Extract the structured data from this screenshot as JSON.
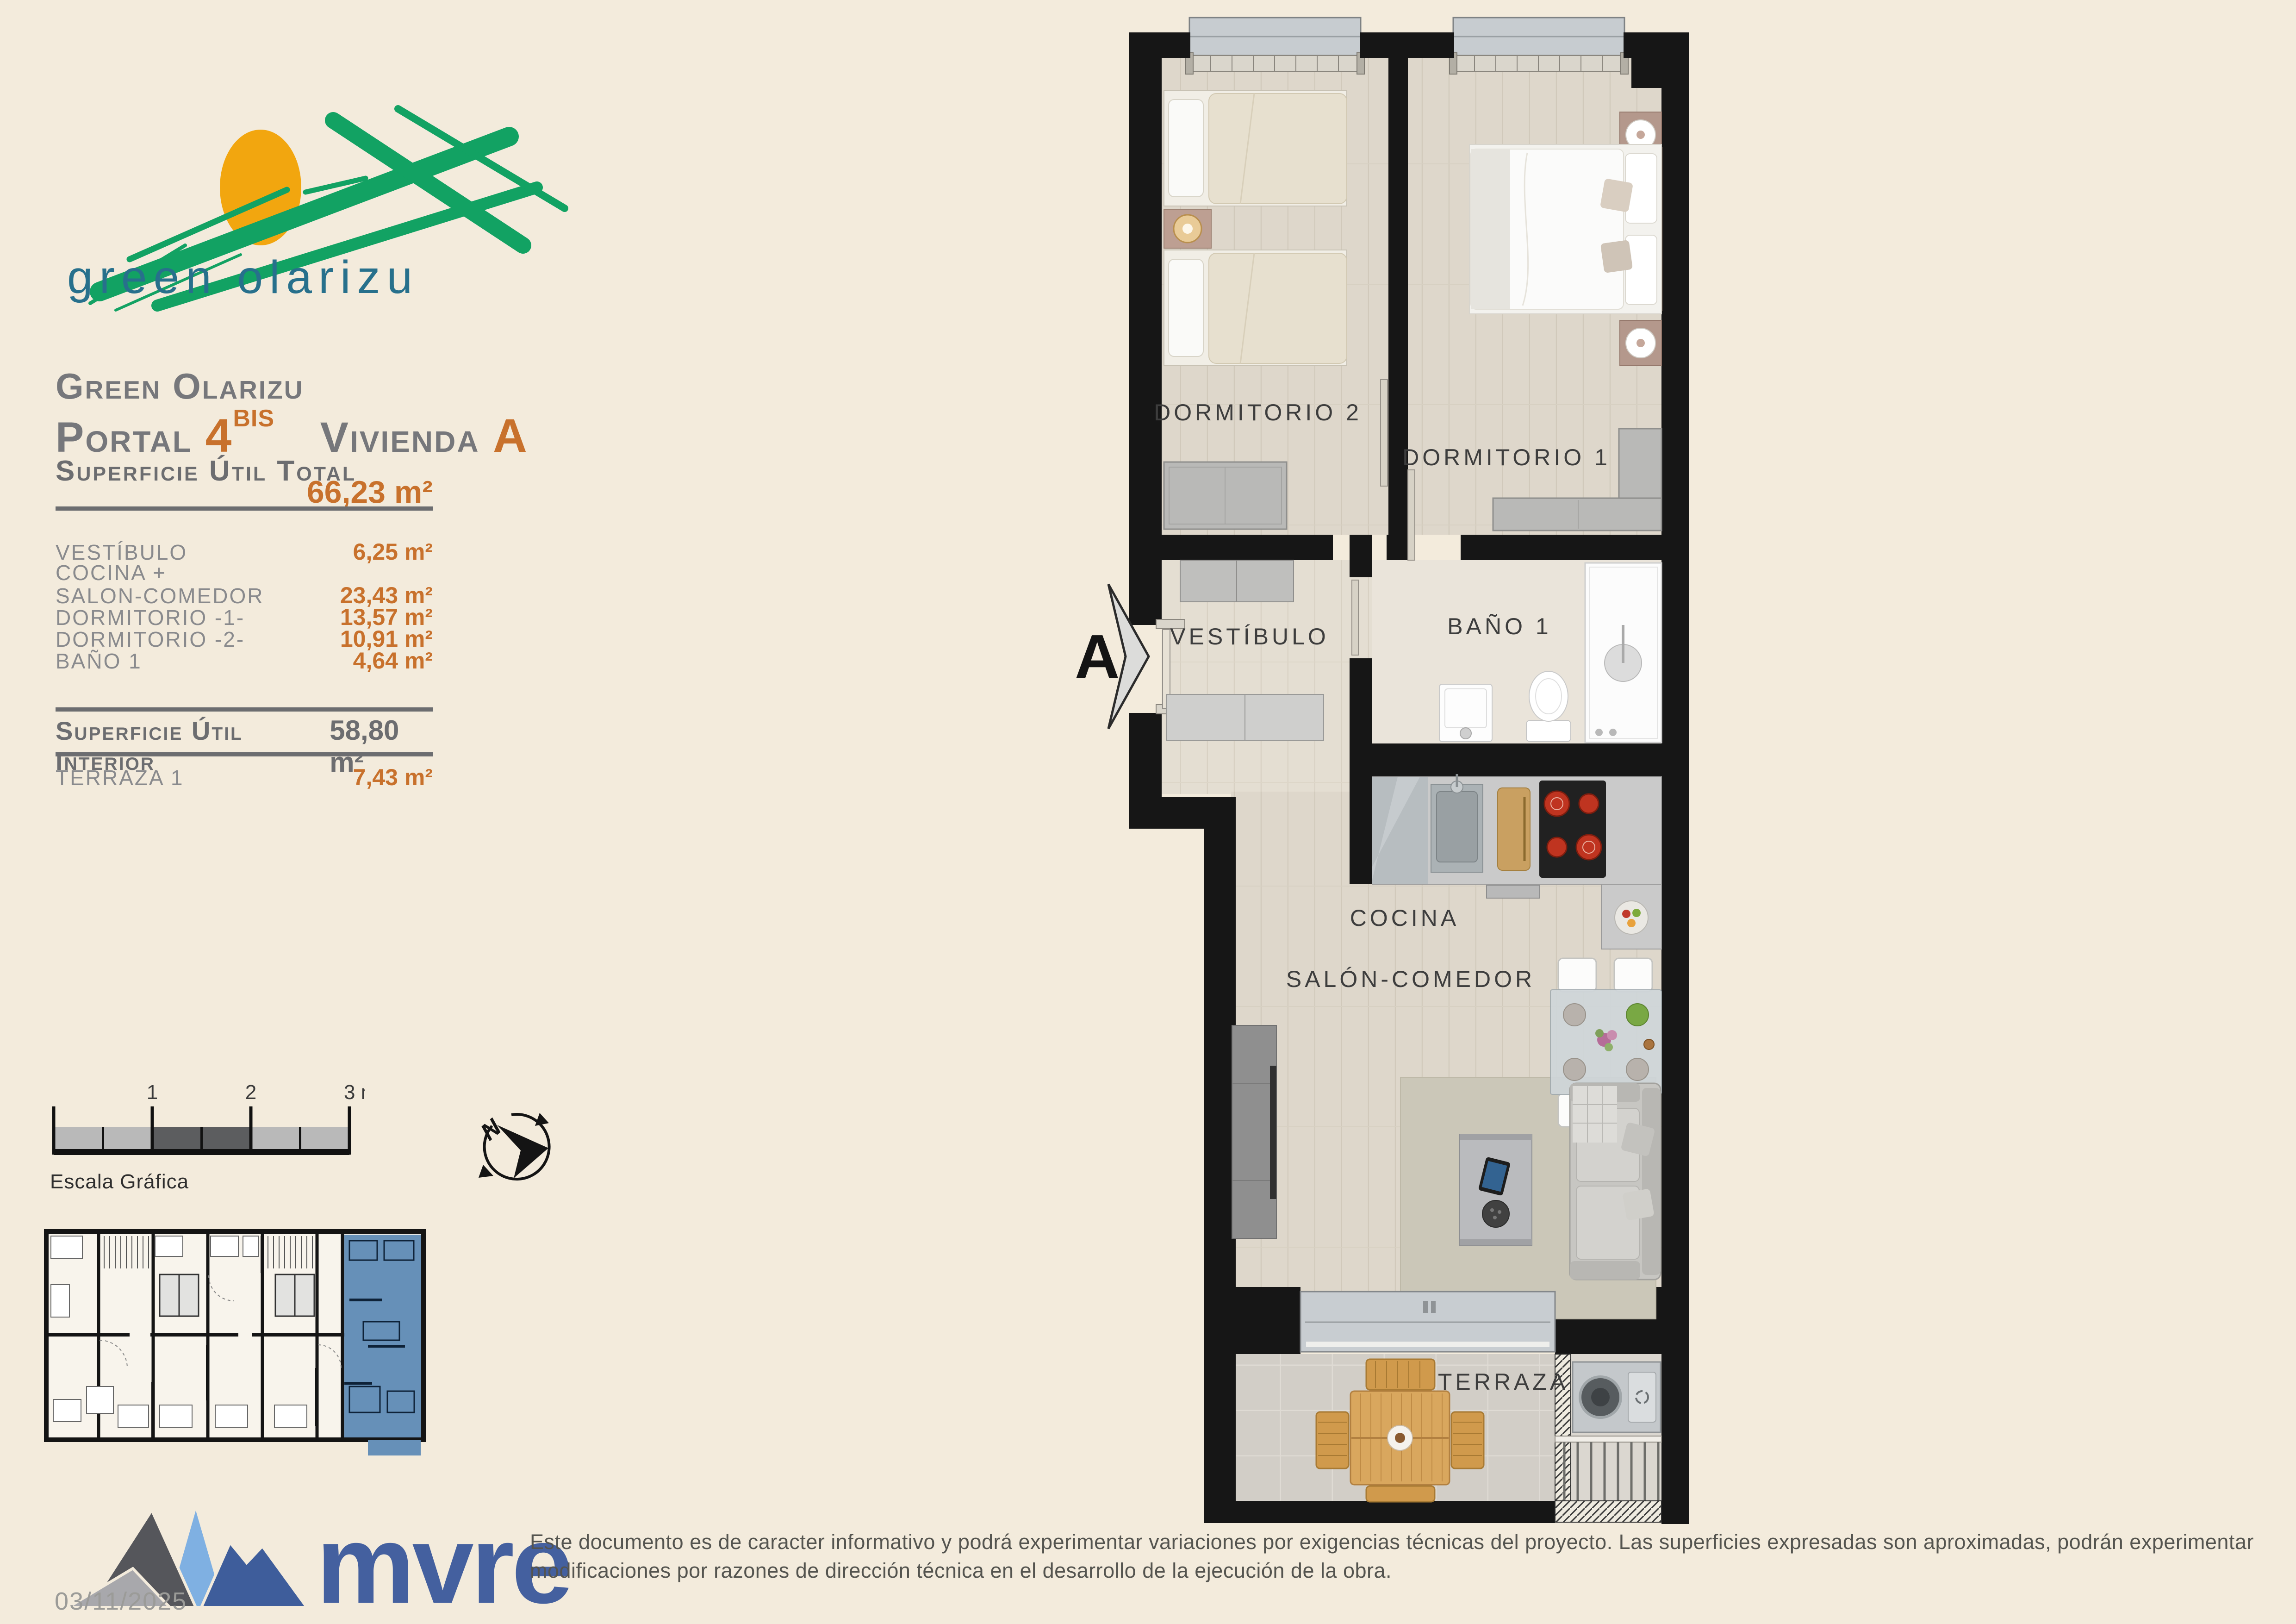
{
  "colors": {
    "background": "#f3ebdc",
    "accent_orange": "#c8712c",
    "text_gray": "#6c6d70",
    "row_gray": "#898a8d",
    "logo_green": "#12a263",
    "logo_teal": "#27708c",
    "sun_orange": "#f2a60f",
    "mvre_blue": "#44609f",
    "highlight_blue": "#6690b8",
    "wall_black": "#161616"
  },
  "logo": {
    "text": "green olarizu"
  },
  "header": {
    "project": "Green Olarizu",
    "portal_label": "Portal",
    "portal_number": "4",
    "portal_sup": "BIS",
    "vivienda_label": "Vivienda",
    "vivienda_letter": "A"
  },
  "areas": {
    "total_label": "Superficie Útil Total",
    "total_value": "66,23 m²",
    "rows": [
      {
        "label": "VESTÍBULO",
        "value": "6,25 m²"
      },
      {
        "label": "COCINA +",
        "value": ""
      },
      {
        "label": "SALON-COMEDOR",
        "value": "23,43 m²"
      },
      {
        "label": "DORMITORIO -1-",
        "value": "13,57 m²"
      },
      {
        "label": "DORMITORIO -2-",
        "value": "10,91 m²"
      },
      {
        "label": "BAÑO 1",
        "value": "4,64 m²"
      }
    ],
    "interior_label": "Superficie Útil Interior",
    "interior_value": "58,80 m²",
    "terraza_label": "TERRAZA 1",
    "terraza_value": "7,43 m²"
  },
  "plan": {
    "marker": "A",
    "rooms": {
      "dormitorio2": "DORMITORIO 2",
      "dormitorio1": "DORMITORIO 1",
      "vestibulo": "VESTÍBULO",
      "bano": "BAÑO 1",
      "cocina": "COCINA",
      "salon": "SALÓN-COMEDOR",
      "terraza": "TERRAZA"
    }
  },
  "scale_bar": {
    "tick1": "1",
    "tick2": "2",
    "tick3": "3 m.",
    "caption": "Escala Gráfica"
  },
  "compass": {
    "north": "N"
  },
  "footer": {
    "brand": "mvre",
    "date": "03/11/2025",
    "disclaimer": "Este documento es de caracter informativo y podrá experimentar variaciones por exigencias técnicas del proyecto. Las superficies expresadas son aproximadas, podrán experimentar modificaciones por razones de dirección técnica en el desarrollo de la ejecución de la obra."
  }
}
